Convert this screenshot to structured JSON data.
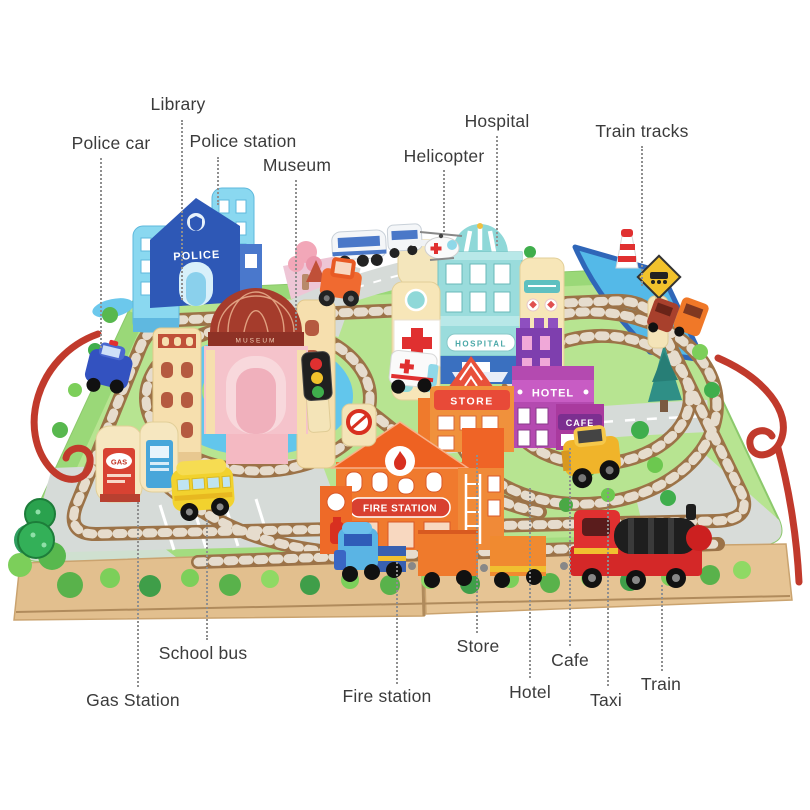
{
  "labels": {
    "library": "Library",
    "police_car": "Police car",
    "police_station": "Police station",
    "museum": "Museum",
    "hospital": "Hospital",
    "helicopter": "Helicopter",
    "train_tracks": "Train tracks",
    "school_bus": "School bus",
    "gas_station": "Gas Station",
    "fire_station": "Fire station",
    "store": "Store",
    "hotel": "Hotel",
    "cafe": "Cafe",
    "taxi": "Taxi",
    "train": "Train"
  },
  "signs": {
    "police": "POLICE",
    "museum": "MUSEUM",
    "hospital": "HOSPITAL",
    "store": "STORE",
    "hotel": "HOTEL",
    "cafe": "CAFE",
    "fire_station": "FIRE STATION",
    "gas": "GAS"
  },
  "colors": {
    "label_text": "#3b3b3b",
    "leader_line": "#8f8f8f",
    "rope_red": "#c13a2c",
    "track_rail": "#9c7348",
    "track_tie": "#e6dccd",
    "grass": "#b7e491",
    "water": "#5fc0ea",
    "road": "#d6dbd8",
    "wood_edge": "#e2bf8e",
    "police_blue": "#2e58b6",
    "hospital_teal": "#9adcdc",
    "cross_red": "#e03030",
    "store_red": "#e84a38",
    "hotel_magenta": "#b44ab0",
    "fire_orange": "#f07a2e",
    "bus_yellow": "#f2d22e",
    "loco_red": "#d42828"
  }
}
